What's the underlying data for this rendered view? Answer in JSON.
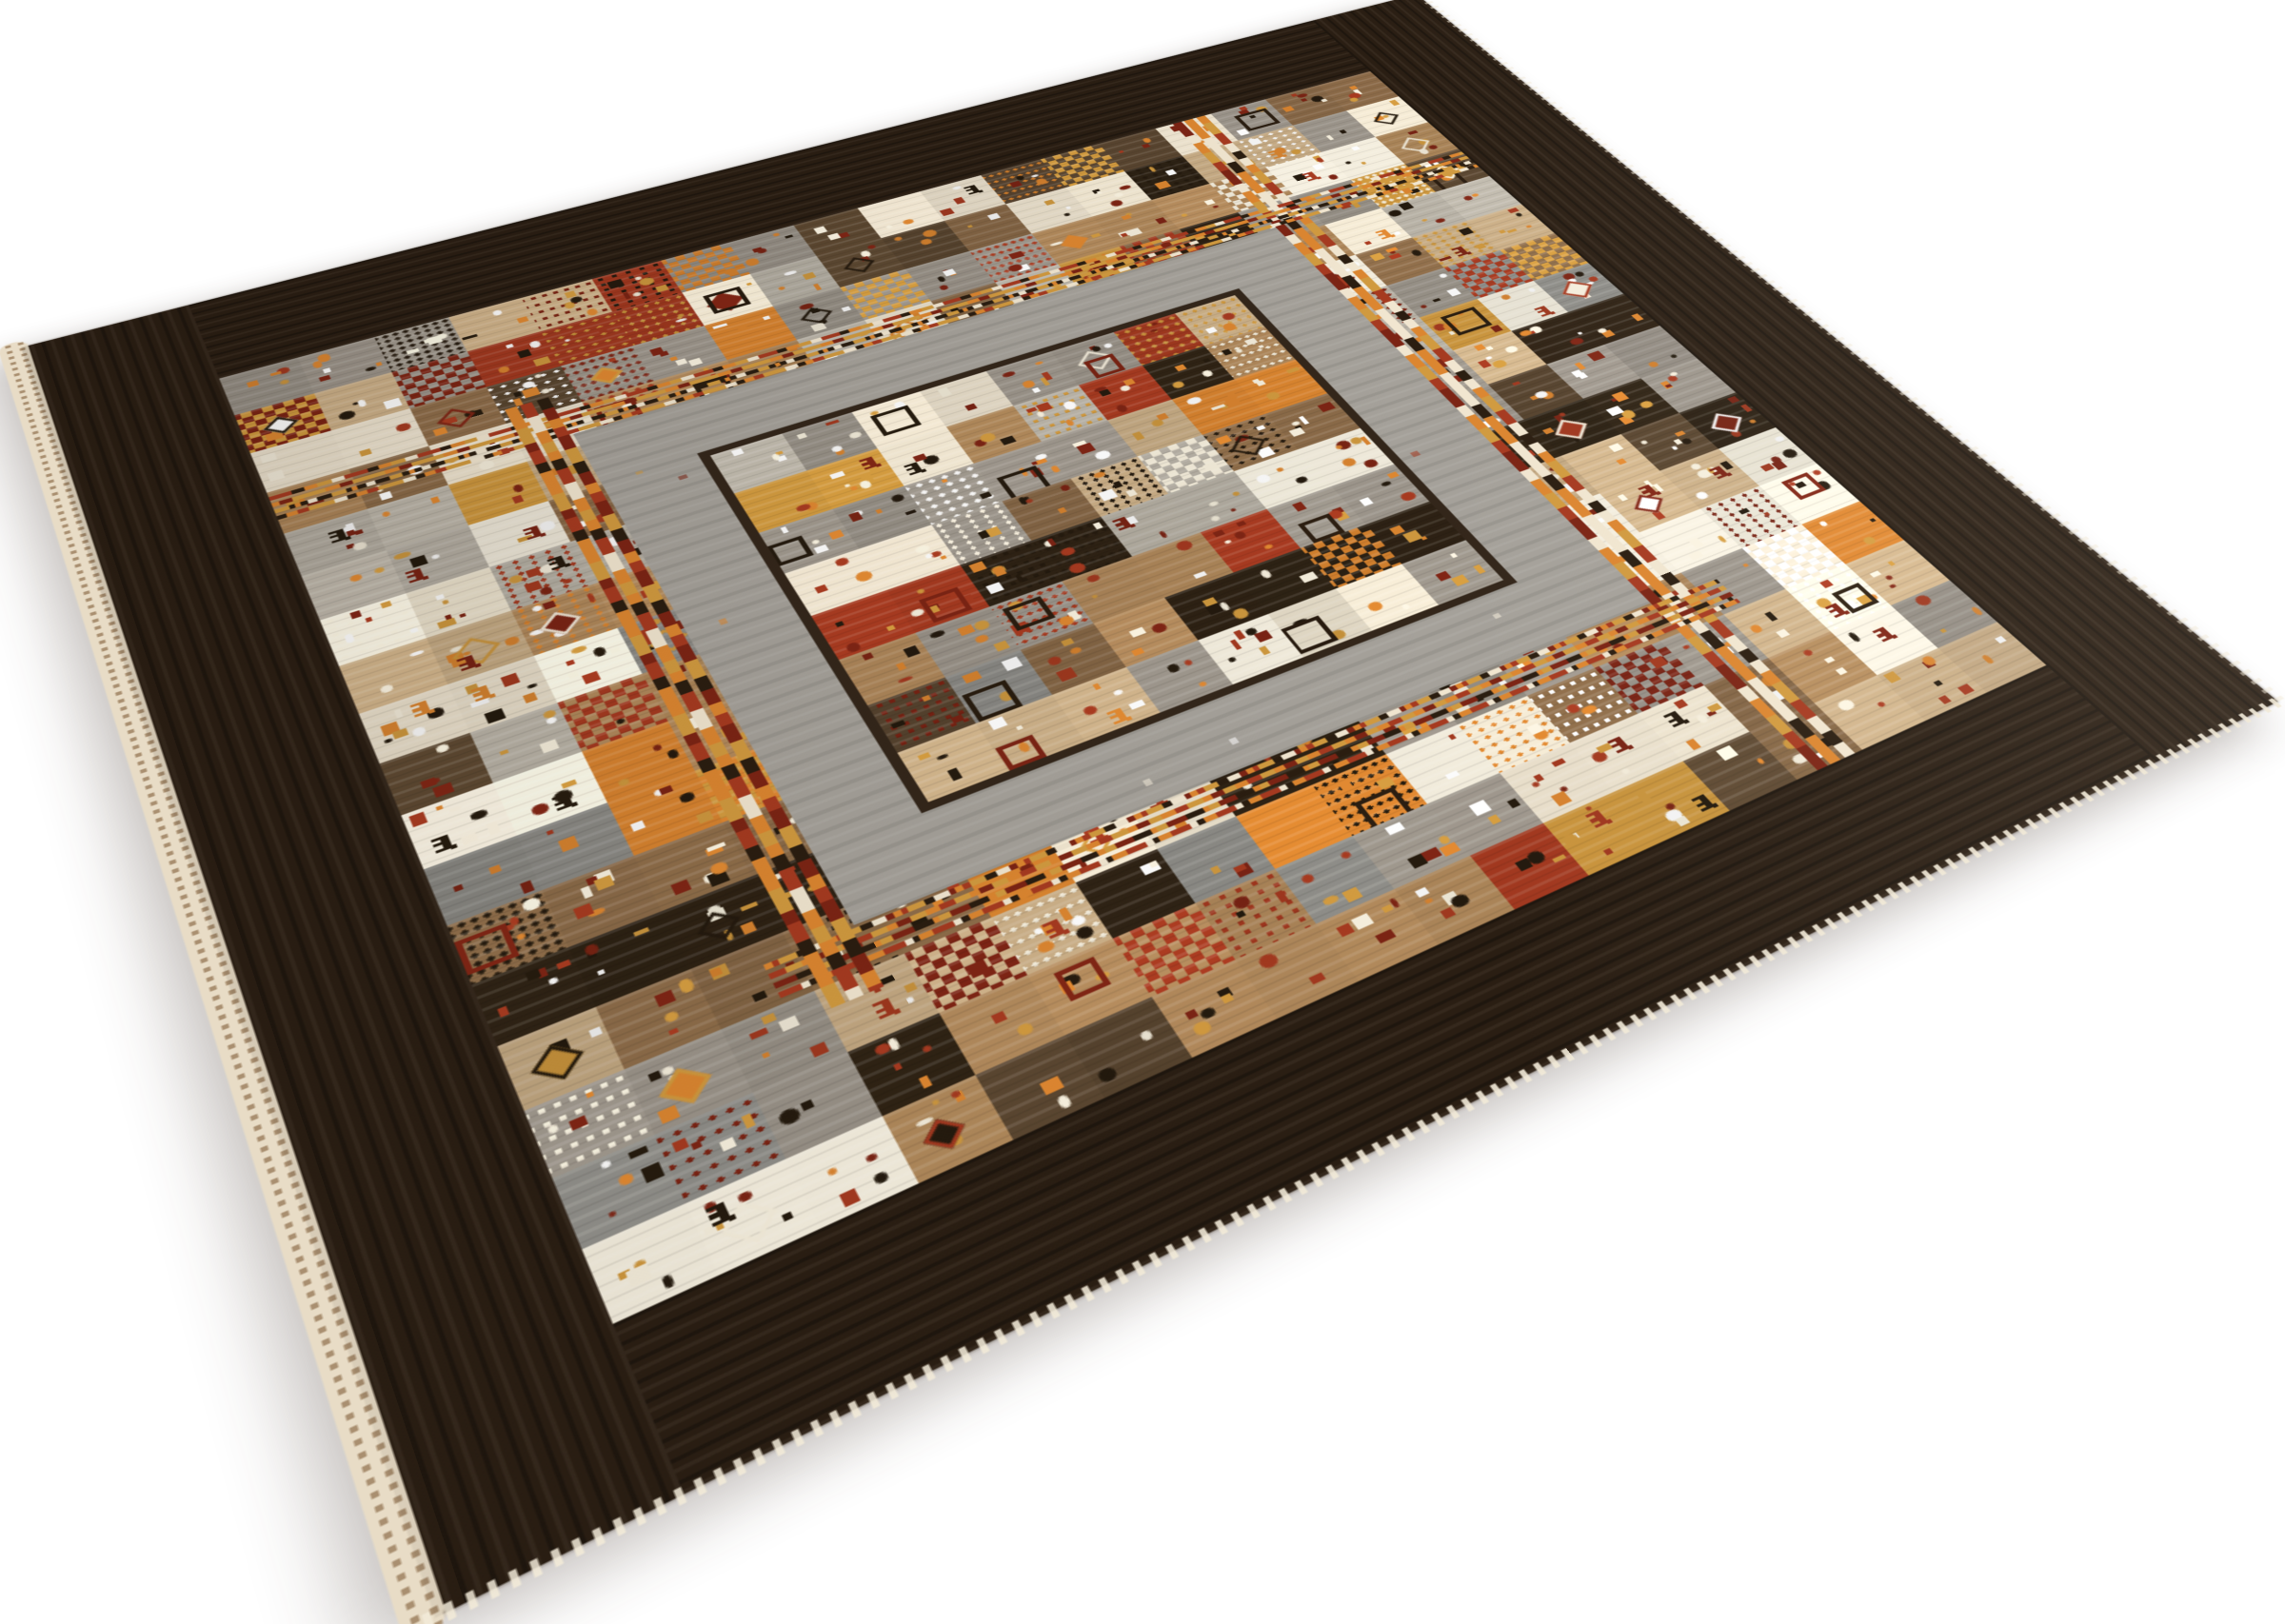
{
  "image": {
    "subject": "Hand-knotted tribal Gabbeh patchwork wool rug lying at an angle on a plain white background",
    "background_color": "#ffffff"
  },
  "rug": {
    "seed": 11,
    "projection": {
      "size": 1000,
      "corners": {
        "top": [
          1488,
          -6
        ],
        "right": [
          2393,
          737
        ],
        "bottom": [
          457,
          1700
        ],
        "left": [
          22,
          365
        ]
      }
    },
    "shadow": {
      "color": "#43342a",
      "opacity": 0.32,
      "blur": 16
    },
    "border": {
      "width": 95,
      "color": "#2a1e13"
    },
    "selvage": {
      "color": "#e8dcc6",
      "dot_color": "#a98f70"
    },
    "fringe_color": "#f2ead8",
    "grid": {
      "origin": 95,
      "cell": 45,
      "cols": 18,
      "rows": 18
    },
    "inner_frame": {
      "stripe_inset": 233,
      "stripe_thickness": 28,
      "gray_inset": 261,
      "gray_size": 478,
      "gray_color": "#a5a19a",
      "line_inset": 318,
      "line_size": 364,
      "line_thickness": 6,
      "line_color": "#33261a"
    },
    "center_field": {
      "origin": 324,
      "cell": 44,
      "cols": 8,
      "rows": 8
    },
    "cell_colors": [
      {
        "c": "#efe5d0",
        "w": 13
      },
      {
        "c": "#f6f0e0",
        "w": 8
      },
      {
        "c": "#cdb189",
        "w": 12
      },
      {
        "c": "#b28a5c",
        "w": 13
      },
      {
        "c": "#8a6a48",
        "w": 10
      },
      {
        "c": "#5a4630",
        "w": 7
      },
      {
        "c": "#2e2214",
        "w": 8
      },
      {
        "c": "#9b948a",
        "w": 10
      },
      {
        "c": "#b9b3a7",
        "w": 8
      },
      {
        "c": "#8e8d88",
        "w": 4
      },
      {
        "c": "#a63a20",
        "w": 5
      },
      {
        "c": "#dc8630",
        "w": 4
      },
      {
        "c": "#d19a3f",
        "w": 3
      }
    ],
    "center_colors": [
      {
        "c": "#9b948a",
        "w": 13
      },
      {
        "c": "#b9b3a7",
        "w": 9
      },
      {
        "c": "#8e8d88",
        "w": 5
      },
      {
        "c": "#b28a5c",
        "w": 11
      },
      {
        "c": "#cdb189",
        "w": 8
      },
      {
        "c": "#8a6a48",
        "w": 10
      },
      {
        "c": "#efe5d0",
        "w": 8
      },
      {
        "c": "#2e2214",
        "w": 9
      },
      {
        "c": "#5a4630",
        "w": 7
      },
      {
        "c": "#a63a20",
        "w": 5
      },
      {
        "c": "#dc8630",
        "w": 4
      },
      {
        "c": "#f6f0e0",
        "w": 4
      },
      {
        "c": "#d19a3f",
        "w": 2
      }
    ],
    "accent_colors": [
      "#dc8630",
      "#a63a20",
      "#7c2414",
      "#f6efdd",
      "#241a0e",
      "#d19a3f",
      "#ffffff"
    ],
    "animal_colors": [
      "#a63a20",
      "#7c2414",
      "#241a0e",
      "#dc8630"
    ],
    "dash_colors": [
      "#7c2414",
      "#dc8630",
      "#2a1d10",
      "#f1e6d0",
      "#a63a20",
      "#d19a3f"
    ]
  }
}
